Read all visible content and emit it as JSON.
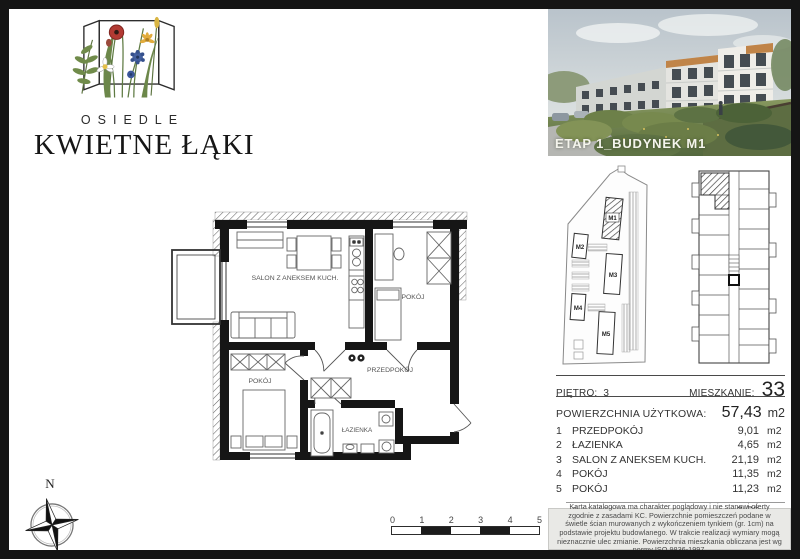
{
  "brand": {
    "subtitle": "OSIEDLE",
    "name": "KWIETNE ŁĄKI"
  },
  "photo": {
    "caption": "ETAP 1_BUDYNEK M1"
  },
  "site_plan": {
    "buildings": [
      "M1",
      "M2",
      "M3",
      "M4",
      "M5"
    ],
    "highlighted": "M1"
  },
  "floor_plan": {
    "rooms": [
      {
        "label": "SALON Z ANEKSEM KUCH."
      },
      {
        "label": "POKÓJ"
      },
      {
        "label": "PRZEDPOKÓJ"
      },
      {
        "label": "POKÓJ"
      },
      {
        "label": "ŁAZIENKA"
      }
    ]
  },
  "compass": {
    "label": "N"
  },
  "scale_bar": {
    "ticks": [
      "0",
      "1",
      "2",
      "3",
      "4",
      "5"
    ]
  },
  "details": {
    "floor_label": "PIĘTRO:",
    "floor_value": "3",
    "apartment_label": "MIESZKANIE:",
    "apartment_value": "33",
    "usable_area_label": "POWIERZCHNIA UŻYTKOWA:",
    "usable_area_value": "57,43",
    "usable_area_unit": "m2",
    "rooms": [
      {
        "no": "1",
        "name": "PRZEDPOKÓJ",
        "area": "9,01",
        "unit": "m2"
      },
      {
        "no": "2",
        "name": "ŁAZIENKA",
        "area": "4,65",
        "unit": "m2"
      },
      {
        "no": "3",
        "name": "SALON Z ANEKSEM KUCH.",
        "area": "21,19",
        "unit": "m2"
      },
      {
        "no": "4",
        "name": "POKÓJ",
        "area": "11,35",
        "unit": "m2"
      },
      {
        "no": "5",
        "name": "POKÓJ",
        "area": "11,23",
        "unit": "m2"
      }
    ],
    "balcony_label": "BALKON",
    "balcony_area": "3,70",
    "balcony_unit": "m2"
  },
  "disclaimer": "Karta katalogowa ma charakter poglądowy i nie stanowi oferty zgodnie z zasadami KC. Powierzchnie pomieszczeń podane w świetle ścian murowanych z wykończeniem tynkiem (gr. 1cm) na podstawie projektu budowlanego. W trakcie realizacji wymiary mogą nieznacznie ulec zmianie. Powierzchnia mieszkania obliczana jest wg normy ISO 9836-1997.",
  "colors": {
    "frame": "#151515",
    "hatch": "#444444",
    "disclaimer_bg": "#e9e9e6",
    "caption": "#f4f4ec"
  }
}
